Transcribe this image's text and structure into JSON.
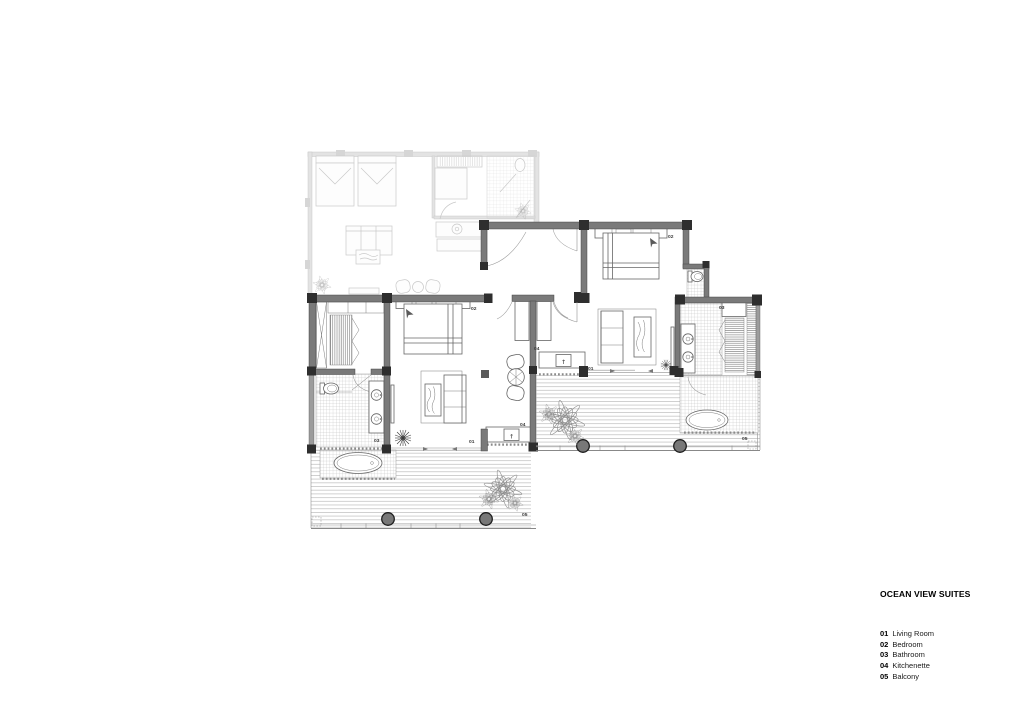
{
  "legend": {
    "title": "OCEAN VIEW SUITES",
    "items": [
      {
        "code": "01",
        "label": "Living Room"
      },
      {
        "code": "02",
        "label": "Bedroom"
      },
      {
        "code": "03",
        "label": "Bathroom"
      },
      {
        "code": "04",
        "label": "Kitchenette"
      },
      {
        "code": "05",
        "label": "Balcony"
      }
    ]
  },
  "plan": {
    "type": "architectural floor plan, two mirrored ocean view suites plus faded adjacent suite",
    "units": {
      "left_suite": {
        "living": "01",
        "bedroom": "02",
        "bathroom": "03",
        "kitchenette": "04",
        "balcony": "05"
      },
      "right_suite": {
        "living": "01",
        "bedroom": "02",
        "bathroom": "03",
        "kitchenette": "04",
        "balcony": "05"
      }
    },
    "symbols": {
      "kitchenette_unit": "↑"
    },
    "colors": {
      "wall_fill": "#7a7a7a",
      "column_fill": "#2e2e2e",
      "drawing_line": "#666666",
      "faded_unit_line": "#c9c9c9",
      "background": "#ffffff"
    }
  }
}
